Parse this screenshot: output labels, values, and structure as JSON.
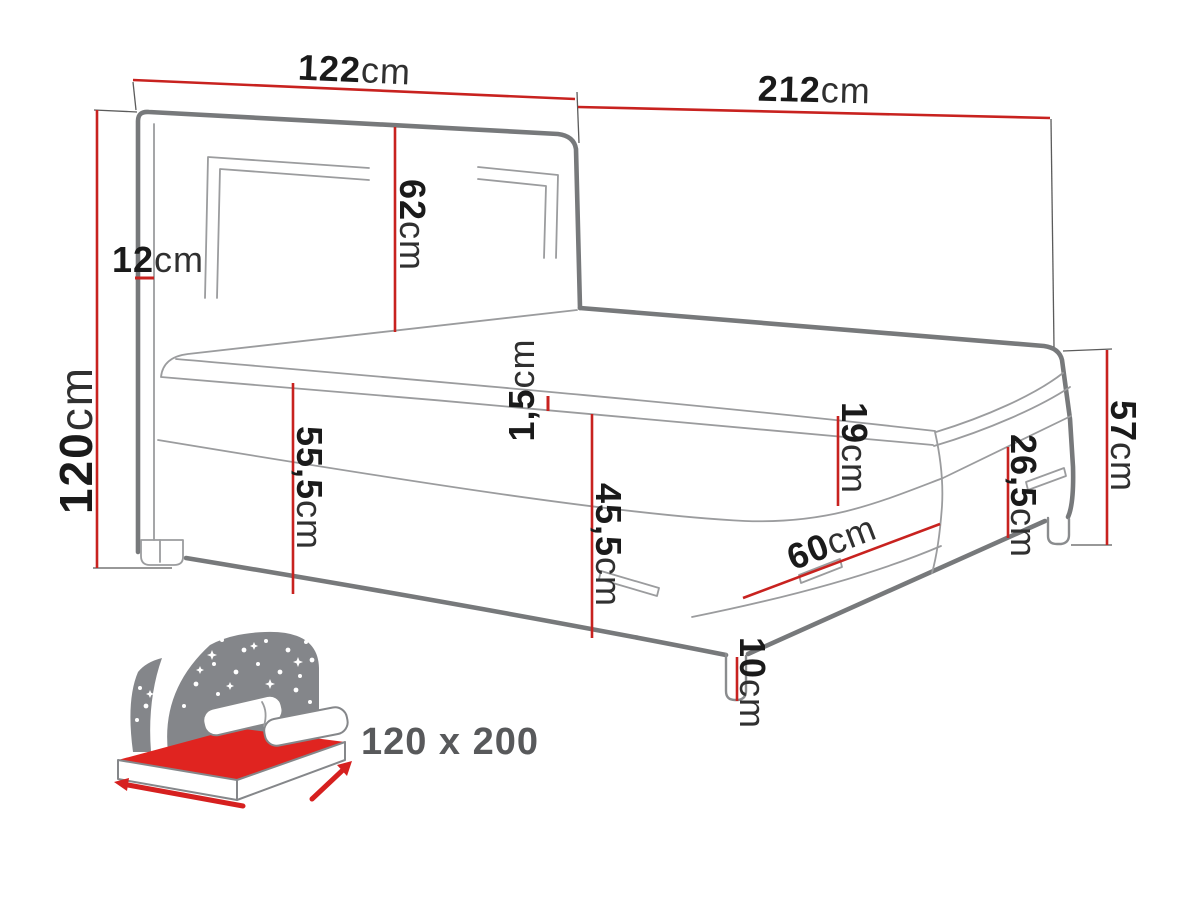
{
  "colors": {
    "dimension_red": "#c8221f",
    "outline_gray": "#77797b",
    "seam_gray": "#9b9c9e",
    "label_dark": "#1a1a1a",
    "size_label_gray": "#58595b",
    "icon_gray": "#84868a",
    "icon_red": "#e02420"
  },
  "dimensions": {
    "headboard_width": {
      "value": "122",
      "unit": "cm"
    },
    "bed_length": {
      "value": "212",
      "unit": "cm"
    },
    "headboard_panel": {
      "value": "62",
      "unit": "cm"
    },
    "headboard_depth": {
      "value": "12",
      "unit": "cm"
    },
    "headboard_height": {
      "value": "120",
      "unit": "cm"
    },
    "topper_thickness": {
      "value": "1,5",
      "unit": "cm"
    },
    "side_height_front": {
      "value": "55,5",
      "unit": "cm"
    },
    "base_height": {
      "value": "45,5",
      "unit": "cm"
    },
    "mattress_thickness": {
      "value": "19",
      "unit": "cm"
    },
    "drawer_width": {
      "value": "60",
      "unit": "cm"
    },
    "side_height_rear": {
      "value": "57",
      "unit": "cm"
    },
    "footboard_panel": {
      "value": "26,5",
      "unit": "cm"
    },
    "leg_height": {
      "value": "10",
      "unit": "cm"
    }
  },
  "legend": {
    "bed_size": "120 x 200"
  }
}
